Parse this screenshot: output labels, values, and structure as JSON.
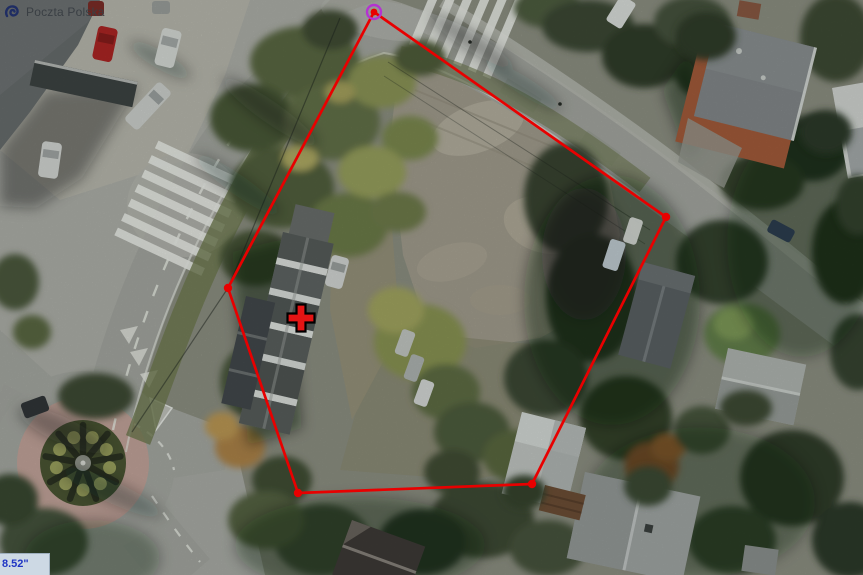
{
  "watermark": {
    "label": "Poczta Polska"
  },
  "coordinate_readout": {
    "value": "8.52\""
  },
  "map": {
    "imagery": "aerial-orthophoto",
    "parcel_boundary": {
      "stroke_color": "#e80000",
      "vertices": [
        {
          "x": 374,
          "y": 12,
          "selected": true
        },
        {
          "x": 666,
          "y": 217
        },
        {
          "x": 532,
          "y": 484
        },
        {
          "x": 298,
          "y": 493
        },
        {
          "x": 228,
          "y": 288
        }
      ],
      "selected_ring_color": "#b433d1"
    },
    "point_marker": {
      "shape": "cross",
      "x": 301,
      "y": 318,
      "fill": "#e41414",
      "outline": "#000000"
    }
  }
}
